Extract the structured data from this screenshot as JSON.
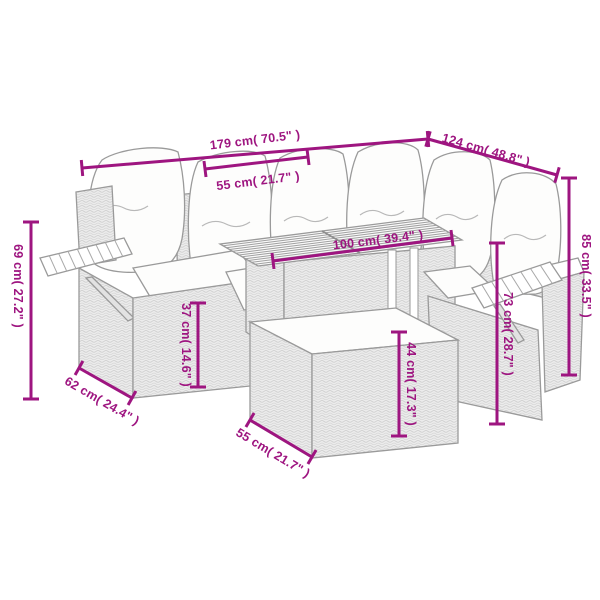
{
  "page": {
    "type": "product-dimension-diagram",
    "background_color": "#ffffff",
    "accent_color": "#9E1580",
    "furniture_outline_color": "#9a9a9a"
  },
  "diagram": {
    "subject": "rattan-corner-sofa-set-with-table-ottoman-and-side-trays",
    "dimensions": [
      {
        "id": "total-width",
        "label": "179 cm( 70.5\" )"
      },
      {
        "id": "wing-length",
        "label": "124 cm( 48.8\" )"
      },
      {
        "id": "seat-width",
        "label": "55 cm( 21.7\" )"
      },
      {
        "id": "table-length",
        "label": "100 cm( 39.4\" )"
      },
      {
        "id": "total-height",
        "label": "85 cm( 33.5\" )"
      },
      {
        "id": "left-height",
        "label": "69 cm( 27.2\" )"
      },
      {
        "id": "seat-height",
        "label": "37 cm( 14.6\" )"
      },
      {
        "id": "ottoman-height",
        "label": "44 cm( 17.3\" )"
      },
      {
        "id": "armrest-height",
        "label": "73 cm( 28.7\" )"
      },
      {
        "id": "seat-depth",
        "label": "62 cm( 24.4\" )"
      },
      {
        "id": "ottoman-depth",
        "label": "55 cm( 21.7\" )"
      }
    ]
  }
}
